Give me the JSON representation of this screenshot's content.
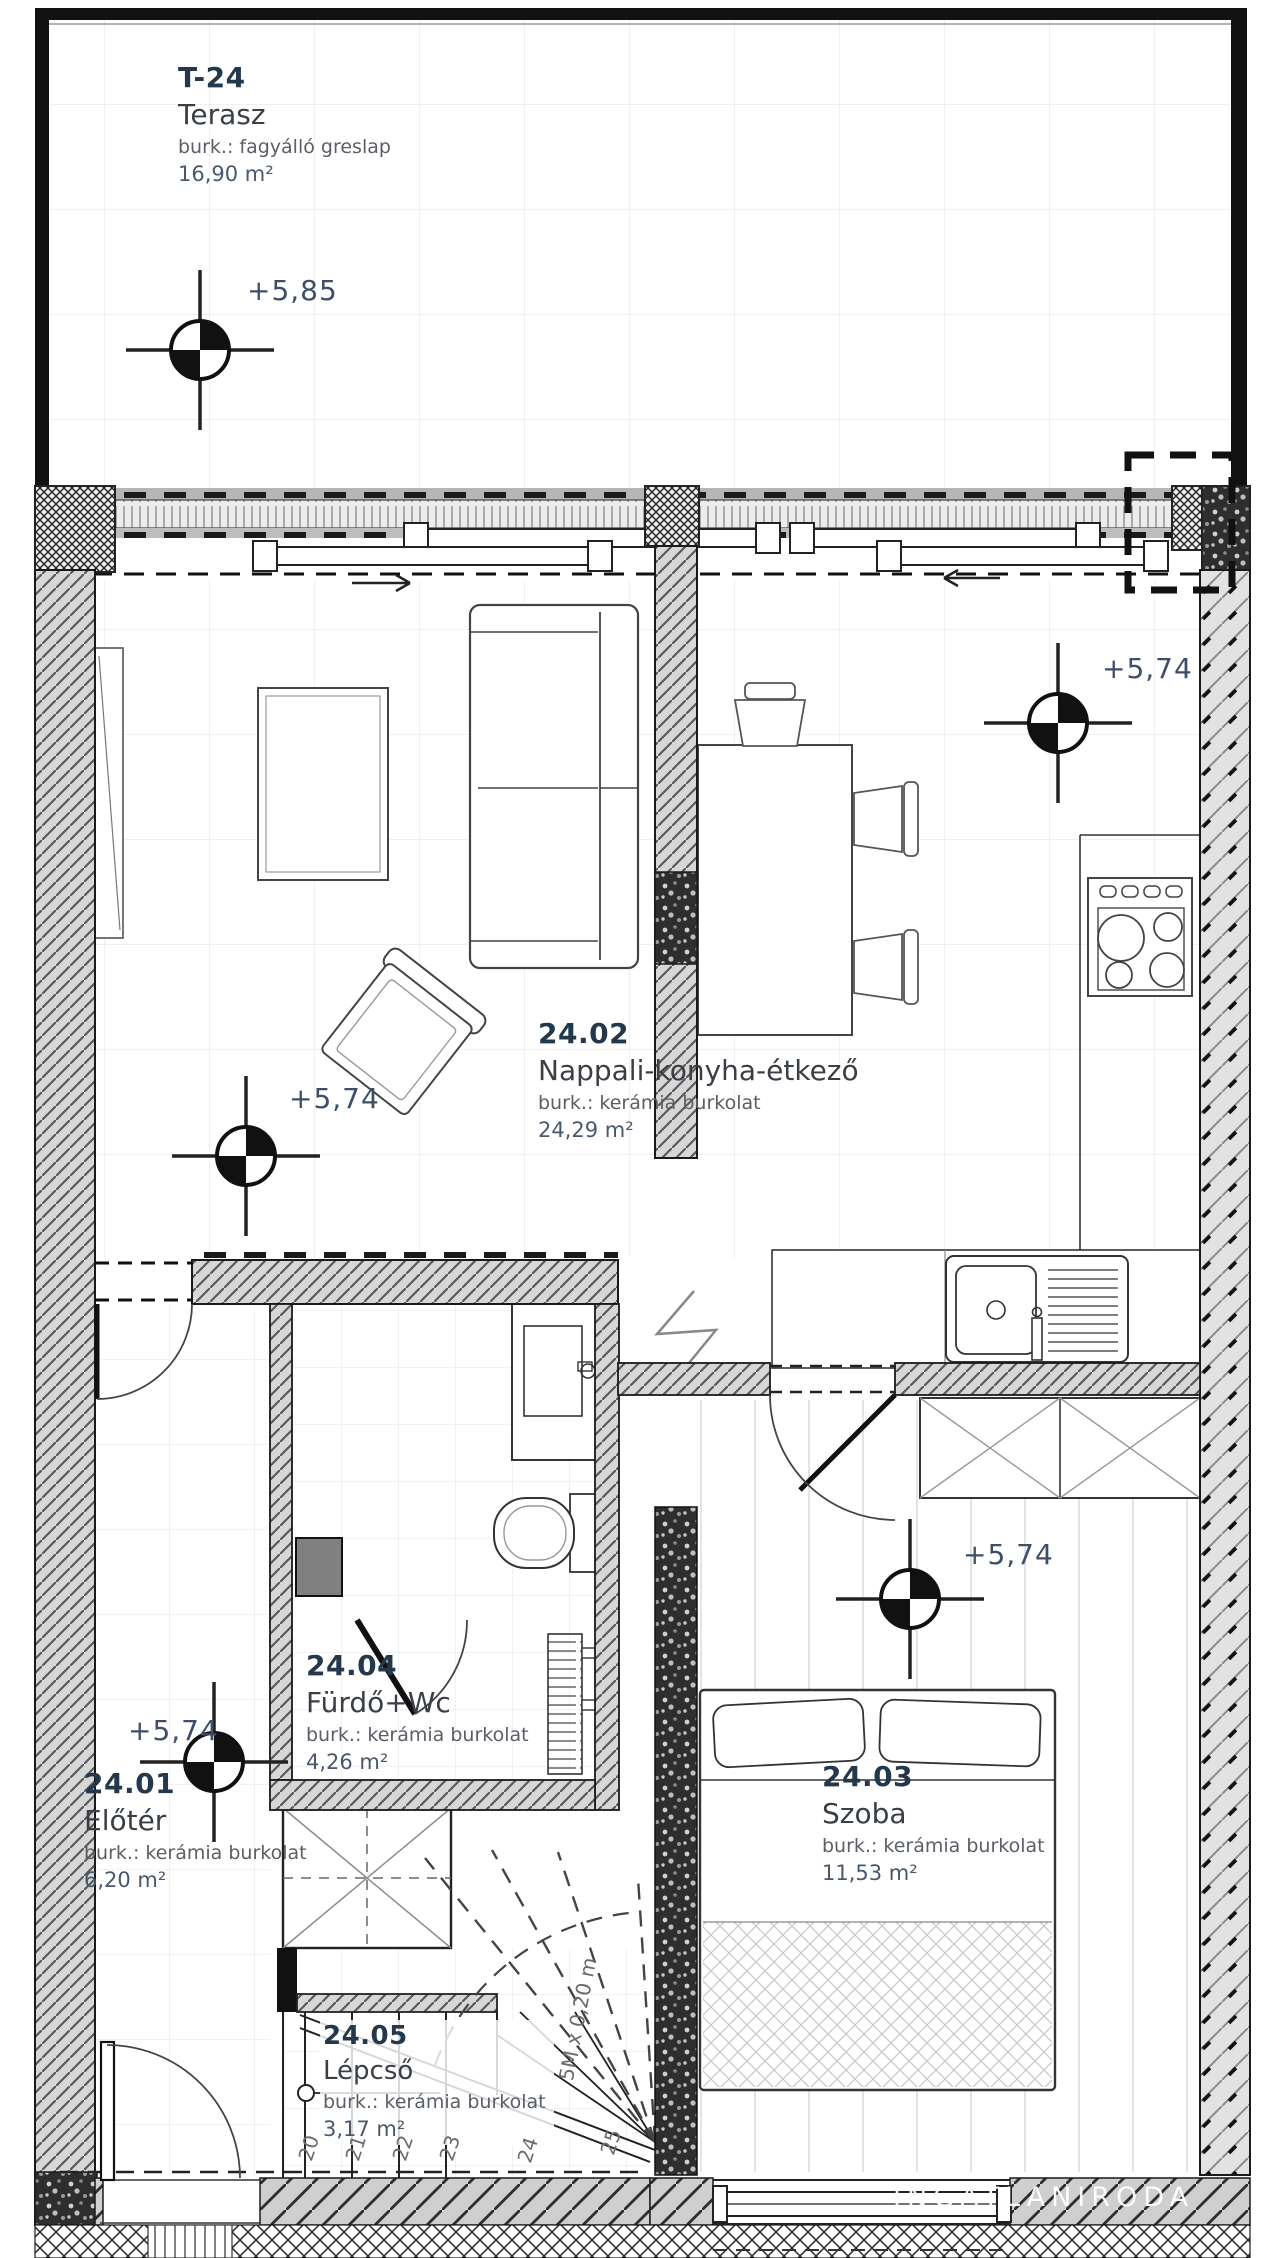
{
  "plan": {
    "rooms": [
      {
        "id": "T-24",
        "name": "Terasz",
        "finish": "burk.: fagyálló greslap",
        "area": "16,90 m²"
      },
      {
        "id": "24.02",
        "name": "Nappali-konyha-étkező",
        "finish": "burk.: kerámia burkolat",
        "area": "24,29 m²"
      },
      {
        "id": "24.01",
        "name": "Előtér",
        "finish": "burk.: kerámia burkolat",
        "area": "6,20 m²"
      },
      {
        "id": "24.04",
        "name": "Fürdő+Wc",
        "finish": "burk.: kerámia burkolat",
        "area": "4,26 m²"
      },
      {
        "id": "24.03",
        "name": "Szoba",
        "finish": "burk.: kerámia burkolat",
        "area": "11,53 m²"
      },
      {
        "id": "24.05",
        "name": "Lépcső",
        "finish": "burk.: kerámia burkolat",
        "area": "3,17 m²"
      }
    ],
    "elevations": [
      "+5,85",
      "+5,74",
      "+5,74",
      "+5,74",
      "+5,74"
    ],
    "stair": {
      "tread_numbers": [
        "20",
        "21",
        "22",
        "23",
        "24",
        "25"
      ],
      "dimension_note": "5M x 0,20 m"
    },
    "watermark": "INGATLANIRODA",
    "colors": {
      "line": "#222222",
      "wall_fill": "#d7d7d7",
      "room_id": "#24384c",
      "muted_text": "#5a5f66",
      "elevation_text": "#3d4e66"
    }
  }
}
